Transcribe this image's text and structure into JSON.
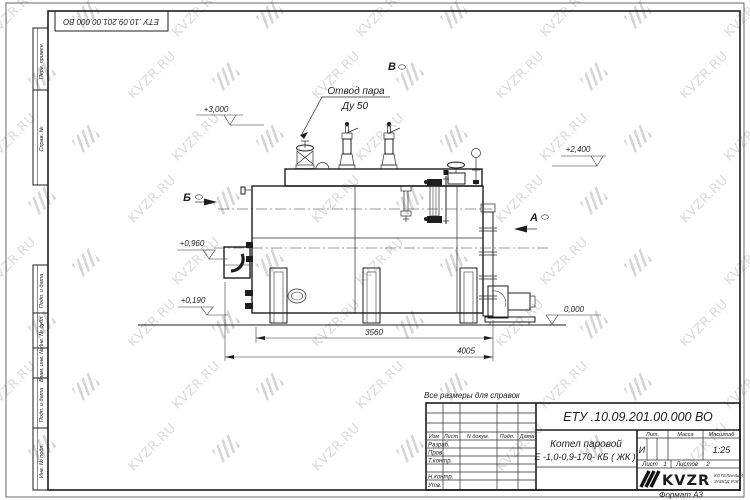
{
  "sheet": {
    "watermark": "KVZR.RU",
    "format_note": "Формат  А3",
    "reference_note": "Все размеры для справок"
  },
  "corner_stamp": {
    "doc_number": "ЕТУ .10.09.201.00.000  ВО"
  },
  "margin_stamps": {
    "perv_primen": "Перв. примен.",
    "sprav_no": "Справ. №",
    "podp_data_1": "Подп. и дата",
    "inv_dubl": "Инв. № дубл.",
    "vzam_inv": "Взам. инв. №",
    "podp_data_2": "Подп. и дата",
    "inv_podl": "Инв. № подл."
  },
  "title_block": {
    "doc_number": "ЕТУ .10.09.201.00.000  ВО",
    "name_line1": "Котел паровой",
    "name_line2": "Е -1,0-0,9-170- КБ ( ЖК )",
    "col_izm": "Изм",
    "col_list": "Лист",
    "col_doc": "N докум.",
    "col_podp": "Подп.",
    "col_data": "Дата",
    "row_razrab": "Разраб.",
    "row_prov": "Пров.",
    "row_tkontr": "Т.контр.",
    "row_nkontr": "Н.контр.",
    "row_utv": "Утв.",
    "lit_label": "Лит.",
    "lit_value": "И",
    "mass_label": "Масса",
    "scale_label": "Масштаб",
    "scale_value": "1:25",
    "sheet_label": "Лист",
    "sheet_value": "1",
    "sheets_label": "Листов",
    "sheets_value": "2",
    "logo_text": "KVZR",
    "logo_sub1": "КОТЕЛЬНЫЙ",
    "logo_sub2": "ЗАВОД РЭП"
  },
  "drawing": {
    "callout_line1": "Отвод пара",
    "callout_line2": "Ду 50",
    "view_b": "Б",
    "view_v": "В",
    "view_a": "А",
    "elev_3000": "+3,000",
    "elev_2400": "+2,400",
    "elev_0960": "+0,960",
    "elev_0190": "+0,190",
    "elev_0000": "0,000",
    "dim_3560": "3560",
    "dim_4005": "4005"
  }
}
